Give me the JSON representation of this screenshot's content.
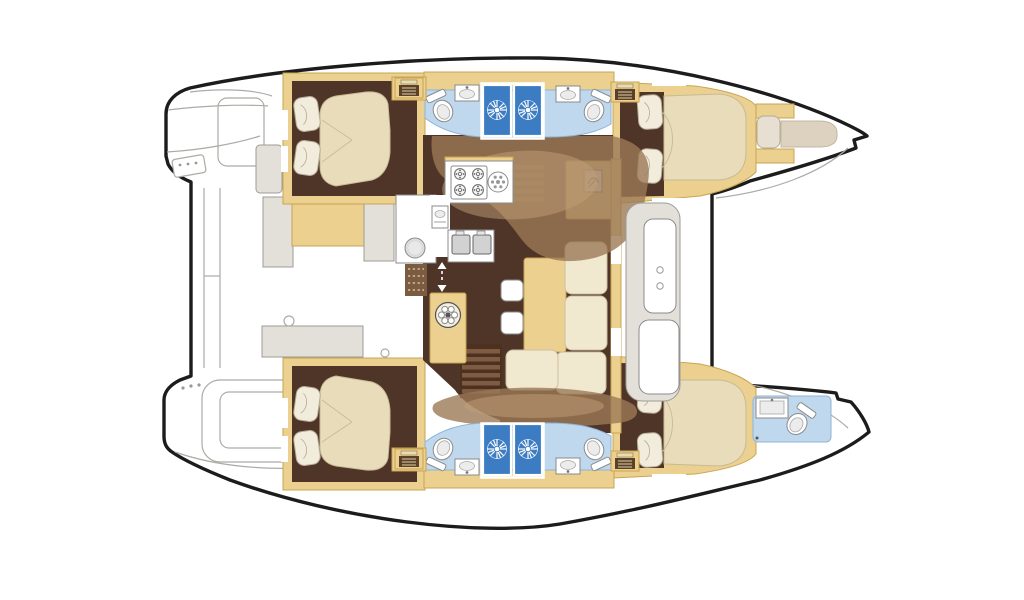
{
  "palette": {
    "hullOutline": "#1c1c1c",
    "deckLine": "#adaba6",
    "deckPanel": "#e3e0da",
    "grayEdge": "#9e9b95",
    "wood": "#ecd08f",
    "woodEdge": "#c9a553",
    "woodDark": "#5d4028",
    "floorDark": "#4f3428",
    "overlayTan": "#9b7956",
    "overlayLight": "#c2a077",
    "mattress": "#e8dcba",
    "mattressEdge": "#c9ba96",
    "pillow": "#f2ecdd",
    "pillowEdge": "#b6ac94",
    "bathFloor": "#bfd8ee",
    "bathEdge": "#8fb3d6",
    "showerBlue": "#3c7cc2",
    "fixtureLine": "#8b8b8b",
    "fixtureFill": "#ffffff",
    "basinFill": "#ececec",
    "stairBase": "#4c3121",
    "stairTread": "#7e5b41",
    "sofa": "#f1e8d0",
    "sofaEdge": "#cdc0a0",
    "matBrown": "#7b5b41",
    "matDot": "#cdb389"
  },
  "diagram": {
    "type": "boat-floor-plan",
    "subject": "catamaran interior layout, top-down view",
    "orientation": {
      "bows": "right",
      "sterns": "left"
    },
    "hulls": [
      {
        "name": "port-hull-top",
        "compartments": [
          "aft-double-cabin",
          "amidships-bathrooms-with-two-showers",
          "forward-double-cabin",
          "forepeak-berth"
        ]
      },
      {
        "name": "starboard-hull-bottom",
        "compartments": [
          "aft-double-cabin",
          "amidships-bathrooms-with-two-showers",
          "forward-double-cabin",
          "bow-head-with-toilet-and-basin"
        ]
      }
    ],
    "bridgedeck": {
      "areas": [
        "aft-cockpit-with-bench-and-table",
        "salon-galley",
        "dinette-with-l-sofa-and-table",
        "nav-cabinet",
        "forward-cockpit-seats",
        "transom-swim-platforms"
      ]
    },
    "fixtures": {
      "double_berths": 4,
      "single_berths": 1,
      "showers": 4,
      "toilets": 5,
      "washbasins": 5,
      "stove_burners": 4,
      "companionway_stairs": 2,
      "hatch_icons": 4,
      "galley_sinks": 2
    }
  }
}
